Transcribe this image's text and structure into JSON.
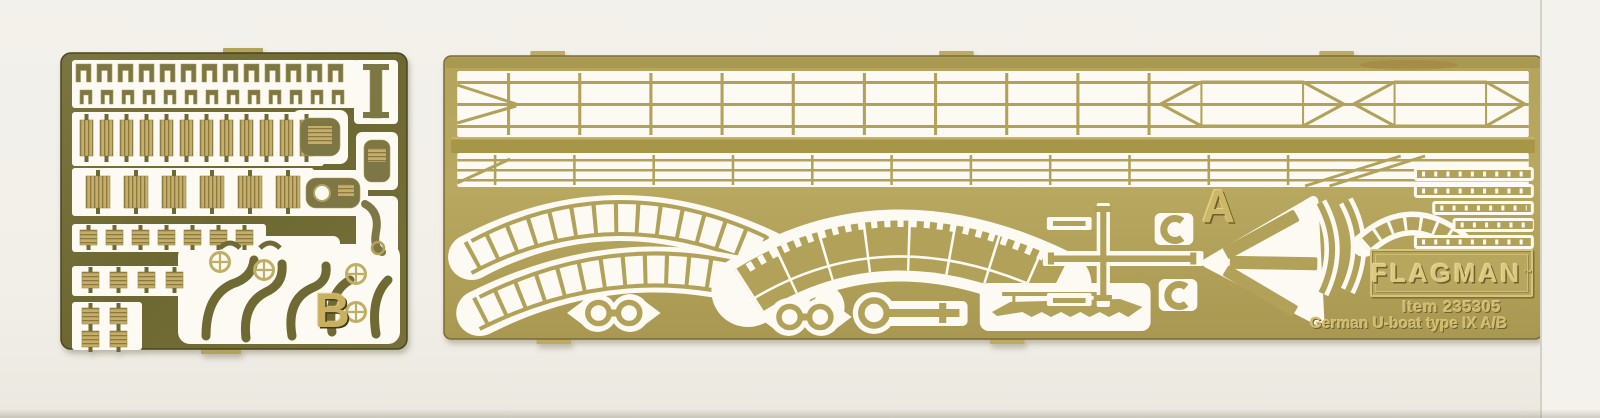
{
  "photo": {
    "background_color": "#f1efe8",
    "fret_a": {
      "label": "A",
      "brand": "FLAGMAN",
      "trademark": "™",
      "item_line": "Item 235305",
      "subject_line": "German U-boat type IX A/B",
      "brass_color": "#b2a158",
      "cutout_color": "#fcfaf3"
    },
    "fret_b": {
      "label": "B",
      "brass_color": "#706b35",
      "part_color": "#c7ae68",
      "cutout_color": "#fcfaf3"
    }
  }
}
